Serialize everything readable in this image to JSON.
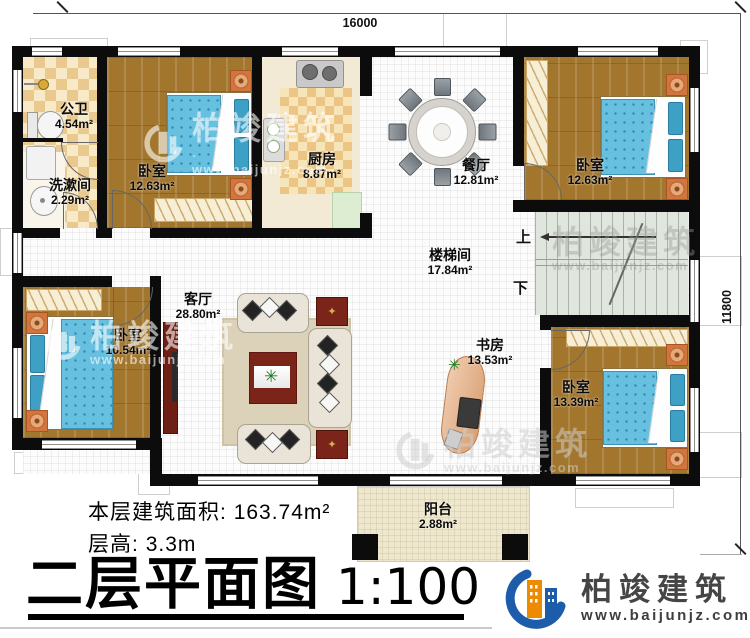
{
  "dimensions": {
    "top": "16000",
    "right": "11800"
  },
  "rooms": [
    {
      "name": "公卫",
      "area": "4.54m²"
    },
    {
      "name": "洗漱间",
      "area": "2.29m²"
    },
    {
      "name": "卧室",
      "area": "12.63m²"
    },
    {
      "name": "厨房",
      "area": "8.87m²"
    },
    {
      "name": "餐厅",
      "area": "12.81m²"
    },
    {
      "name": "卧室",
      "area": "12.63m²"
    },
    {
      "name": "楼梯间",
      "area": "17.84m²"
    },
    {
      "name": "客厅",
      "area": "28.80m²"
    },
    {
      "name": "卧室",
      "area": "10.54m²"
    },
    {
      "name": "书房",
      "area": "13.53m²"
    },
    {
      "name": "卧室",
      "area": "13.39m²"
    },
    {
      "name": "阳台",
      "area": "2.88m²"
    }
  ],
  "stairs": {
    "up": "上",
    "down": "下"
  },
  "info": {
    "area_label": "本层建筑面积:",
    "area_value": "163.74m²",
    "height_label": "层高:",
    "height_value": "3.3m"
  },
  "title": {
    "main": "二层平面图",
    "scale": "1:100"
  },
  "brand": {
    "name": "柏竣建筑",
    "url": "www.baijunjz.com"
  },
  "watermark": {
    "name": "柏竣建筑",
    "url": "www.baijunjz.com"
  },
  "colors": {
    "wall": "#0c0c0c",
    "wood_floor": "#a3762e",
    "bed_blue": "#67c0df",
    "checker_tile": "#eac98f",
    "brand_blue": "#1d5bab",
    "brand_orange": "#ee8a00"
  }
}
